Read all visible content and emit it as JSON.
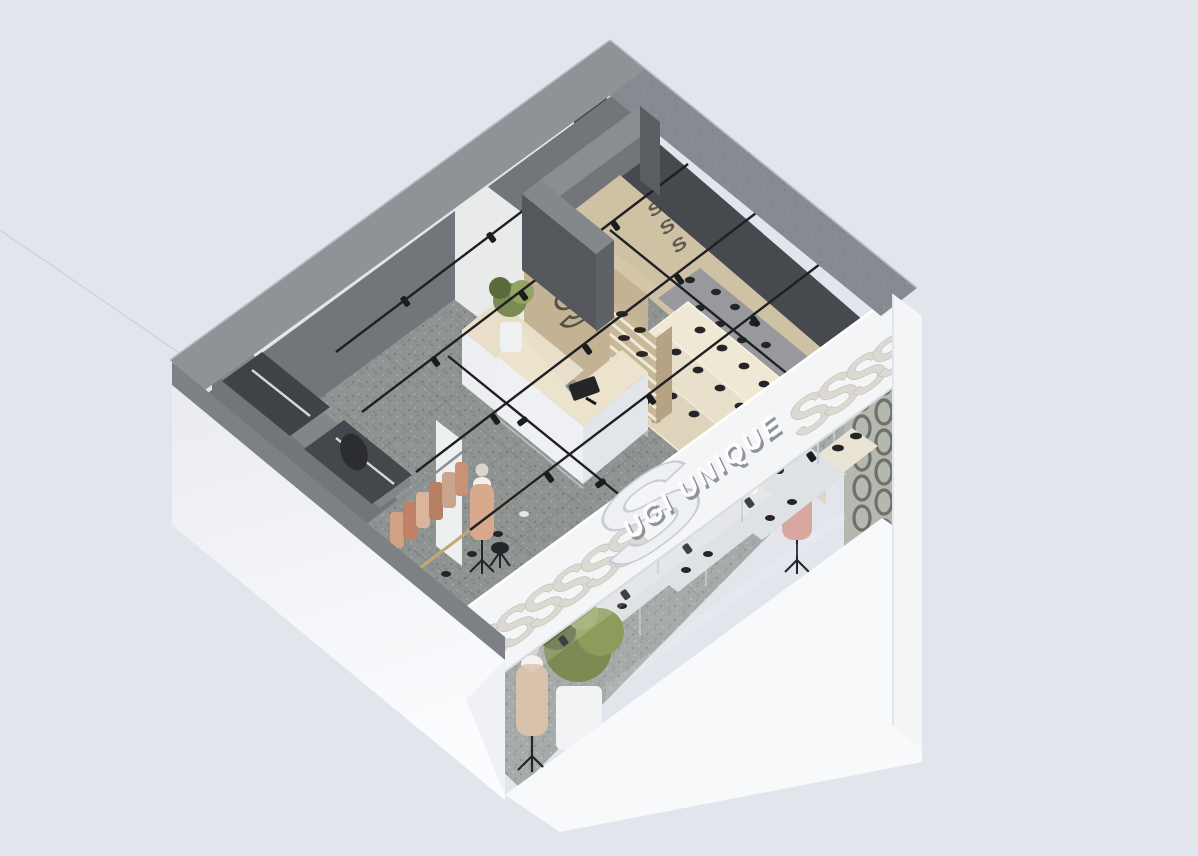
{
  "scene": {
    "subject": "isometric cutaway 3D render of a clothing and shoe boutique interior"
  },
  "brand": {
    "name": "UGI UNIQUE",
    "logo_glyph": "S"
  },
  "colors": {
    "bg": "#e2e5ec",
    "wall_top": "#878b91",
    "wall_top_light": "#8f9398",
    "wall_dark": "#46494e",
    "wall_mid": "#72767b",
    "white_wall": "#eef0f3",
    "white_bright": "#f7f9fb",
    "fascia": "#f4f5f7",
    "emboss": "#dcd9d2",
    "wood": "#c3b293",
    "wood_light": "#d6c6a8",
    "beige_floor": "#cfc2a4",
    "cream": "#efe8d4",
    "floor_gray": "#8f9493",
    "terrazzo_light": "#a9aeac",
    "counter_top": "#ece3cc",
    "gold": "#c3a872",
    "plant": "#7a8a52",
    "plant_dark": "#5c6b3e",
    "tan": "#d2a184",
    "pink": "#d8a8a0",
    "shoe_black": "#232528",
    "chrome": "#d5d9dd",
    "screen_gray": "#b5b8b0",
    "chain_dark": "#5c6057"
  }
}
